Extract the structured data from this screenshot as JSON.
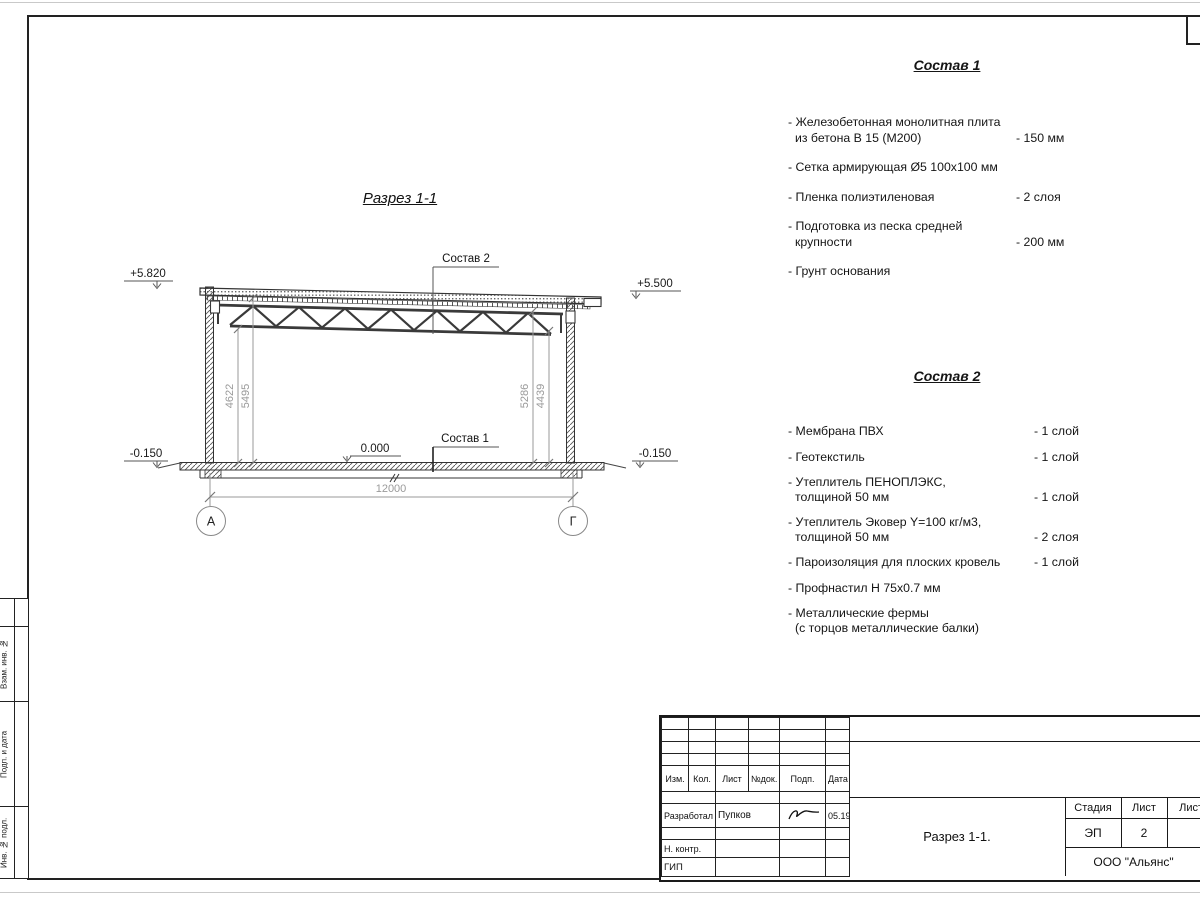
{
  "drawing": {
    "title": "Разрез 1-1",
    "elevation_top_left": "+5.820",
    "elevation_top_right": "+5.500",
    "elevation_bottom_left": "-0.150",
    "elevation_bottom_right": "-0.150",
    "elevation_floor": "0.000",
    "dim_left_inner": "4622",
    "dim_left_outer": "5495",
    "dim_right_outer": "5286",
    "dim_right_inner": "4439",
    "dim_span": "12000",
    "axis_left": "А",
    "axis_right": "Г",
    "leader_roof": "Состав 2",
    "leader_floor": "Состав 1"
  },
  "sostav1": {
    "title": "Состав 1",
    "items": [
      {
        "line1": "- Железобетонная  монолитная плита",
        "line2": "из бетона В 15 (М200)",
        "value": "- 150 мм"
      },
      {
        "line1": "- Сетка армирующая Ø5 100х100 мм",
        "value": ""
      },
      {
        "line1": "- Пленка полиэтиленовая",
        "value": "-  2 слоя"
      },
      {
        "line1": "- Подготовка из песка средней",
        "line2": "крупности",
        "value": "- 200 мм"
      },
      {
        "line1": "- Грунт основания",
        "value": ""
      }
    ]
  },
  "sostav2": {
    "title": "Состав 2",
    "items": [
      {
        "line1": "- Мембрана ПВХ",
        "value": "- 1 слой"
      },
      {
        "line1": "- Геотекстиль",
        "value": "- 1 слой"
      },
      {
        "line1": "- Утеплитель ПЕНОПЛЭКС,",
        "line2": "толщиной 50 мм",
        "value": "- 1 слой"
      },
      {
        "line1": "- Утеплитель Эковер Y=100 кг/м3,",
        "line2": "толщиной 50 мм",
        "value": "- 2 слоя"
      },
      {
        "line1": "- Пароизоляция для плоских кровель",
        "value": "- 1 слой"
      },
      {
        "line1": "- Профнастил Н 75х0.7 мм",
        "value": ""
      },
      {
        "line1": "- Металлические фермы",
        "line2": "(с торцов металлические балки)",
        "value": ""
      }
    ]
  },
  "titleblock": {
    "col_izm": "Изм.",
    "col_kol": "Кол.",
    "col_list": "Лист",
    "col_ndok": "№док.",
    "col_podp": "Подп.",
    "col_data": "Дата",
    "developed_label": "Разработал",
    "developed_name": "Пупков",
    "developed_date": "05.19",
    "ncontr_label": "Н. контр.",
    "gip_label": "ГИП",
    "stage_label": "Стадия",
    "sheet_label": "Лист",
    "sheets_label": "Листов",
    "stage_value": "ЭП",
    "sheet_value": "2",
    "doc_name": "Разрез 1-1.",
    "company": "ООО \"Альянс\""
  },
  "margin_labels": {
    "vzam": "Взам. инв. №",
    "podp_data": "Подп. и дата",
    "inv_podl": "Инв. № подл."
  },
  "colors": {
    "line": "#2f2f2f",
    "dim_text": "#9a9a9a",
    "frame": "#222222"
  }
}
